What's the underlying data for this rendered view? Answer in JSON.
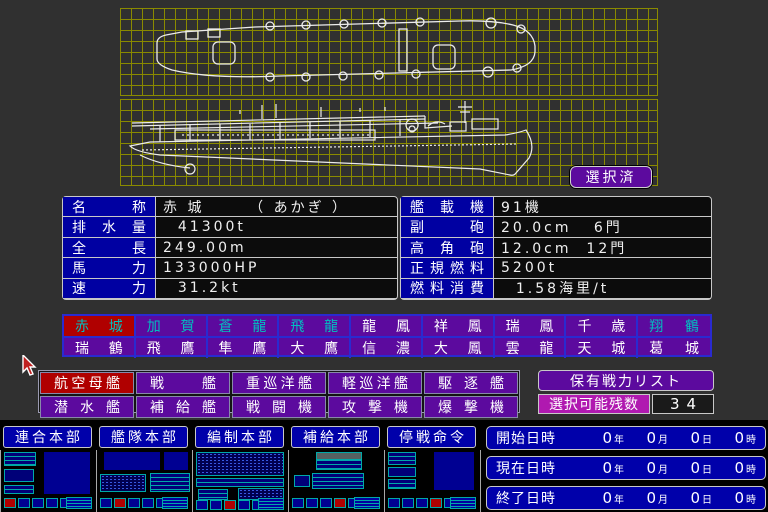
{
  "colors": {
    "selected_red": "#b00000",
    "panel_purple": "#5c0a9e",
    "used_cyan": "#00c0c0",
    "navy": "#0000a2",
    "button_blue": "#0000aa",
    "magenta": "#b019b0",
    "grid_olive": "#8a8a00"
  },
  "icons": {
    "cursor": "arrow-pointer",
    "blueprints": "carrier-top-view, carrier-side-view"
  },
  "blueprint": {
    "selected_badge": "選択済"
  },
  "specs": {
    "left": [
      {
        "label": "名称",
        "value": "赤 城      （ あかぎ ）"
      },
      {
        "label": "排水量",
        "value": "  41300t"
      },
      {
        "label": "全長",
        "value": "249.00m"
      },
      {
        "label": "馬力",
        "value": "133000HP"
      },
      {
        "label": "速力",
        "value": "  31.2kt"
      }
    ],
    "right": [
      {
        "label": "艦載機",
        "value": "91機"
      },
      {
        "label": "副砲",
        "value": "20.0cm   6門"
      },
      {
        "label": "高角砲",
        "value": "12.0cm  12門"
      },
      {
        "label": "正規燃料",
        "value": "5200t"
      },
      {
        "label": "燃料消費",
        "value": "  1.58海里/t"
      }
    ]
  },
  "ships": {
    "row1": [
      {
        "name": "赤城",
        "state": "selected"
      },
      {
        "name": "加賀",
        "state": "used"
      },
      {
        "name": "蒼龍",
        "state": "used"
      },
      {
        "name": "飛龍",
        "state": "used"
      },
      {
        "name": "龍鳳"
      },
      {
        "name": "祥鳳"
      },
      {
        "name": "瑞鳳"
      },
      {
        "name": "千歳"
      },
      {
        "name": "翔鶴",
        "state": "used"
      }
    ],
    "row2": [
      {
        "name": "瑞鶴"
      },
      {
        "name": "飛鷹"
      },
      {
        "name": "隼鷹"
      },
      {
        "name": "大鷹"
      },
      {
        "name": "信濃"
      },
      {
        "name": "大鳳"
      },
      {
        "name": "雲龍"
      },
      {
        "name": "天城"
      },
      {
        "name": "葛城"
      }
    ]
  },
  "categories": {
    "row1": [
      {
        "label": "航空母艦",
        "state": "selected"
      },
      {
        "label": "戦艦"
      },
      {
        "label": "重巡洋艦"
      },
      {
        "label": "軽巡洋艦"
      },
      {
        "label": "駆逐艦"
      }
    ],
    "row2": [
      {
        "label": "潜水艦"
      },
      {
        "label": "補給艦"
      },
      {
        "label": "戦闘機"
      },
      {
        "label": "攻撃機"
      },
      {
        "label": "爆撃機"
      }
    ]
  },
  "force": {
    "title": "保有戦力リスト",
    "remaining_label": "選択可能残数",
    "remaining_value": "34"
  },
  "menu": {
    "items": [
      {
        "label": "連合本部"
      },
      {
        "label": "艦隊本部"
      },
      {
        "label": "編制本部"
      },
      {
        "label": "補給本部"
      },
      {
        "label": "停戦命令"
      }
    ]
  },
  "clock": {
    "rows": [
      {
        "label": "開始日時",
        "n1": "0",
        "u1": "年",
        "n2": "0",
        "u2": "月",
        "n3": "0",
        "u3": "日",
        "n4": "0",
        "u4": "時"
      },
      {
        "label": "現在日時",
        "n1": "0",
        "u1": "年",
        "n2": "0",
        "u2": "月",
        "n3": "0",
        "u3": "日",
        "n4": "0",
        "u4": "時"
      },
      {
        "label": "終了日時",
        "n1": "0",
        "u1": "年",
        "n2": "0",
        "u2": "月",
        "n3": "0",
        "u3": "日",
        "n4": "0",
        "u4": "時"
      }
    ]
  }
}
